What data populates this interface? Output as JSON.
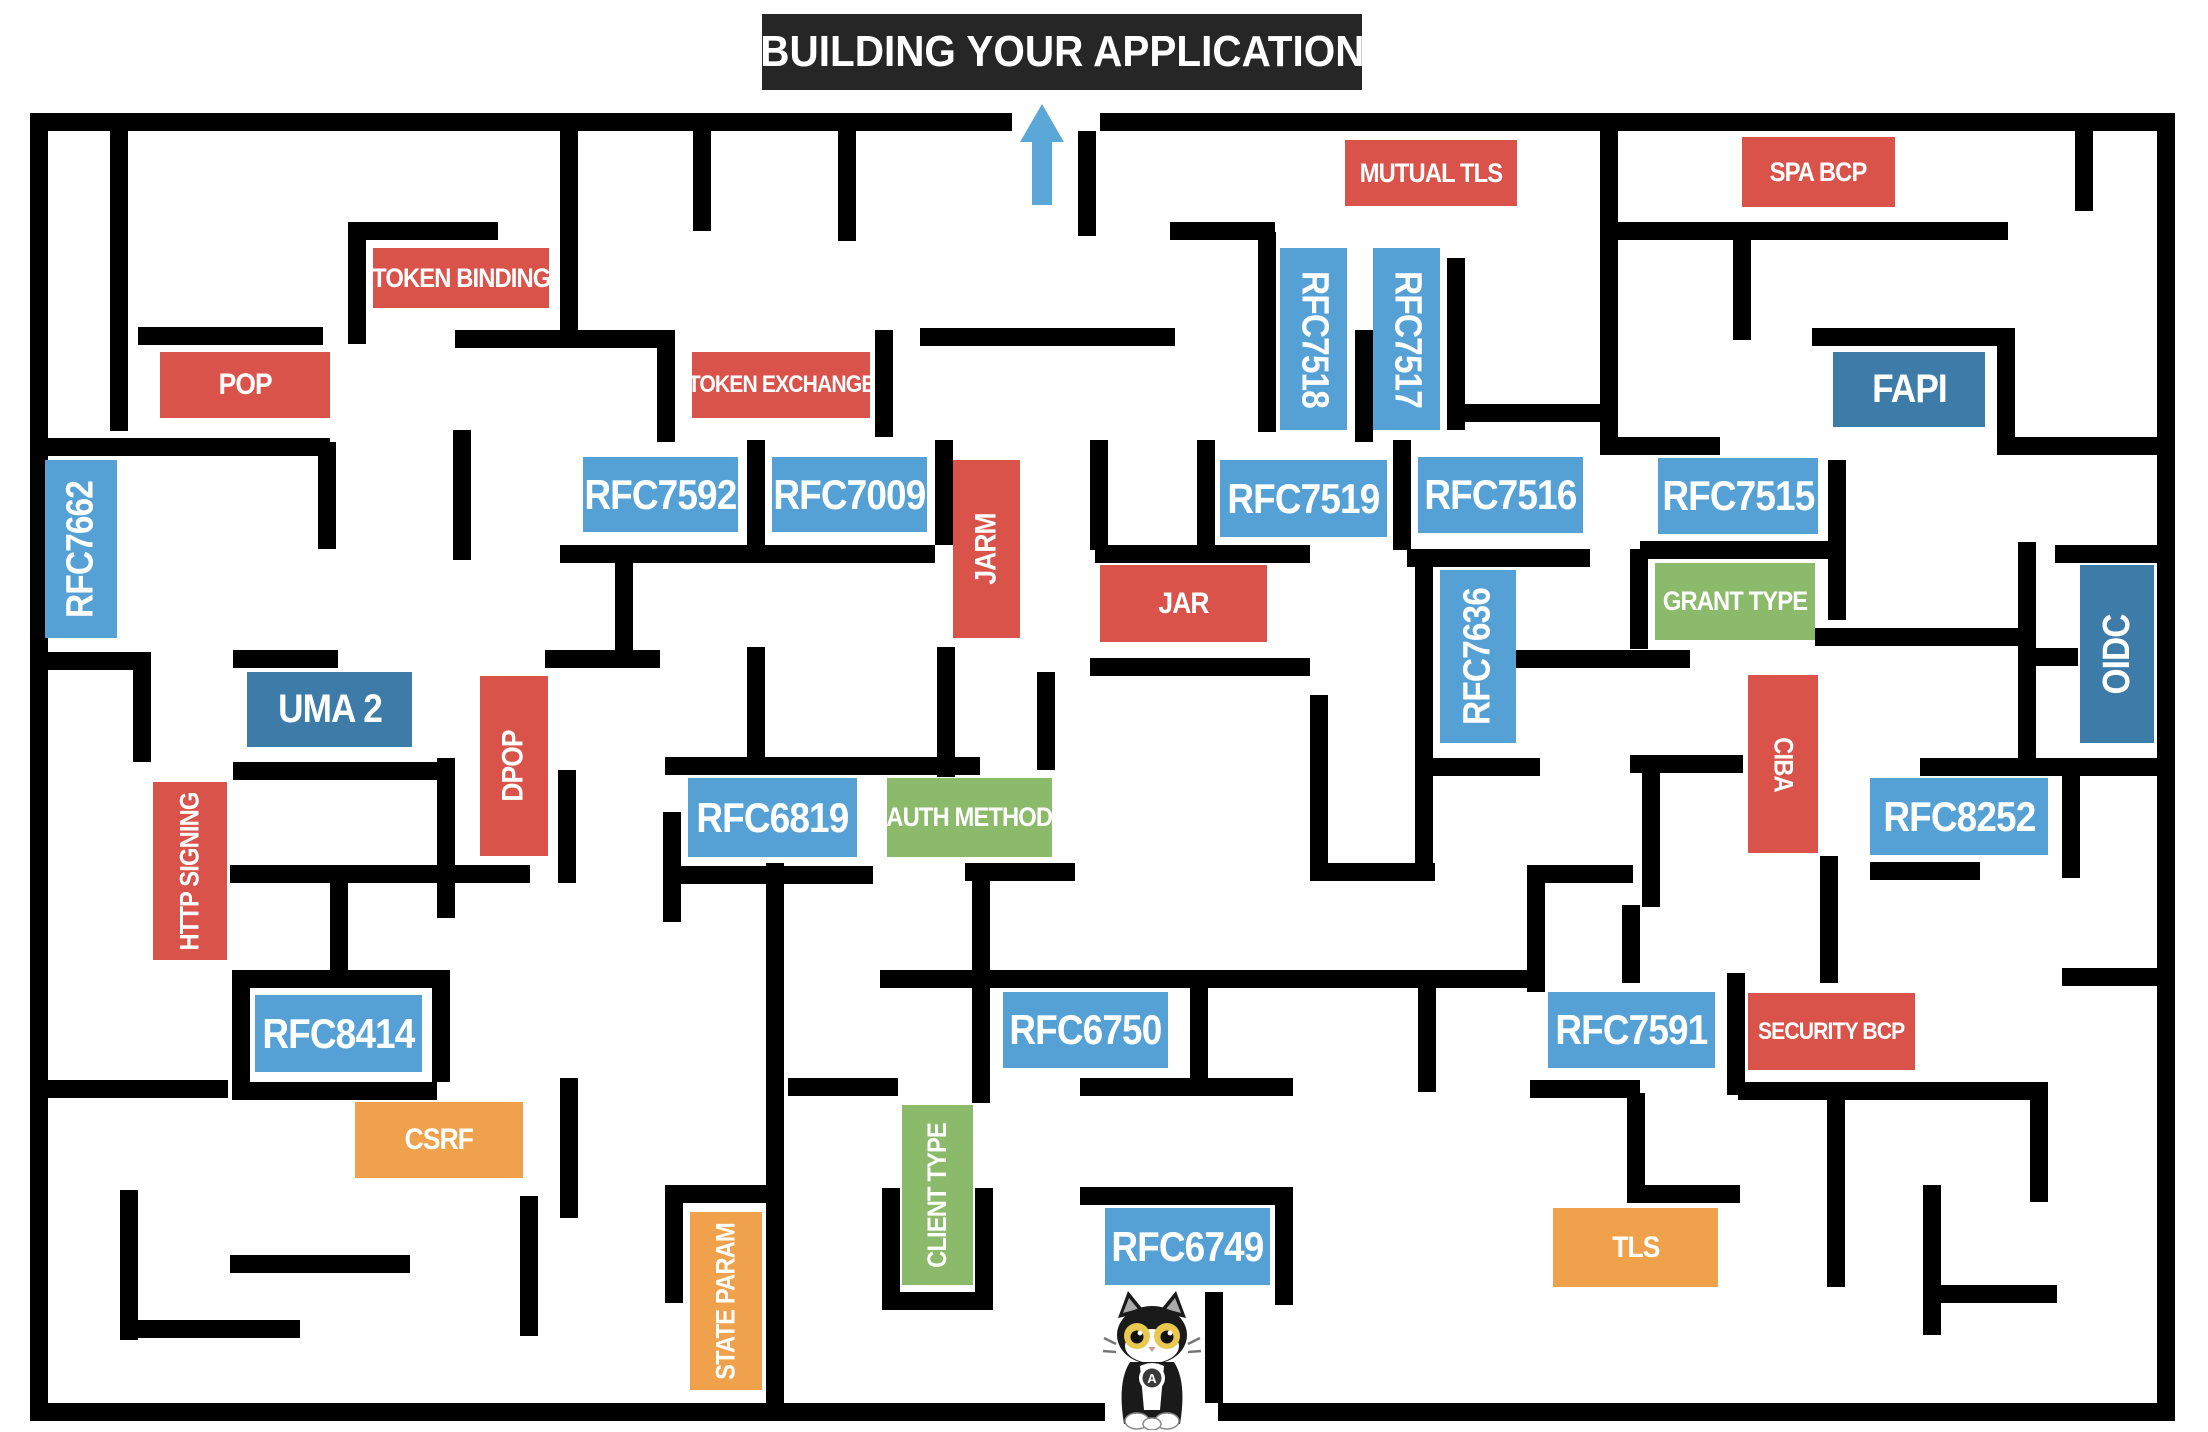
{
  "title": "BUILDING YOUR APPLICATION",
  "colors": {
    "wall": "#000000",
    "title_bg": "#262626",
    "arrow": "#5BA7D8",
    "rfc_blue": "#55A1D6",
    "spec_dark_blue": "#3D7CA9",
    "extension_red": "#D9534B",
    "concept_green": "#8CBA6B",
    "risk_orange": "#F0A14C"
  },
  "arrow": {
    "direction": "up",
    "meaning": "maze exit toward title"
  },
  "cat": {
    "collar_letter": "A"
  },
  "labels": {
    "rfc7662": {
      "text": "RFC7662"
    },
    "pop": {
      "text": "POP"
    },
    "token_binding": {
      "text": "TOKEN BINDING"
    },
    "token_exchange": {
      "text": "TOKEN EXCHANGE"
    },
    "rfc7592": {
      "text": "RFC7592"
    },
    "rfc7009": {
      "text": "RFC7009"
    },
    "jarm": {
      "text": "JARM"
    },
    "jar": {
      "text": "JAR"
    },
    "mutual_tls": {
      "text": "MUTUAL TLS"
    },
    "rfc7518": {
      "text": "RFC7518"
    },
    "rfc7517": {
      "text": "RFC7517"
    },
    "rfc7519": {
      "text": "RFC7519"
    },
    "rfc7516": {
      "text": "RFC7516"
    },
    "rfc7636": {
      "text": "RFC7636"
    },
    "rfc7515": {
      "text": "RFC7515"
    },
    "spa_bcp": {
      "text": "SPA BCP"
    },
    "fapi": {
      "text": "FAPI"
    },
    "grant_type": {
      "text": "GRANT TYPE"
    },
    "oidc": {
      "text": "OIDC"
    },
    "uma2": {
      "text": "UMA 2"
    },
    "dpop": {
      "text": "DPOP"
    },
    "http_signing": {
      "text": "HTTP SIGNING"
    },
    "rfc6819": {
      "text": "RFC6819"
    },
    "auth_method": {
      "text": "AUTH METHOD"
    },
    "ciba": {
      "text": "CIBA"
    },
    "rfc8252": {
      "text": "RFC8252"
    },
    "rfc8414": {
      "text": "RFC8414"
    },
    "csrf": {
      "text": "CSRF"
    },
    "state_param": {
      "text": "STATE PARAM"
    },
    "rfc6750": {
      "text": "RFC6750"
    },
    "client_type": {
      "text": "CLIENT TYPE"
    },
    "rfc6749": {
      "text": "RFC6749"
    },
    "rfc7591": {
      "text": "RFC7591"
    },
    "security_bcp": {
      "text": "SECURITY BCP"
    },
    "tls": {
      "text": "TLS"
    }
  }
}
